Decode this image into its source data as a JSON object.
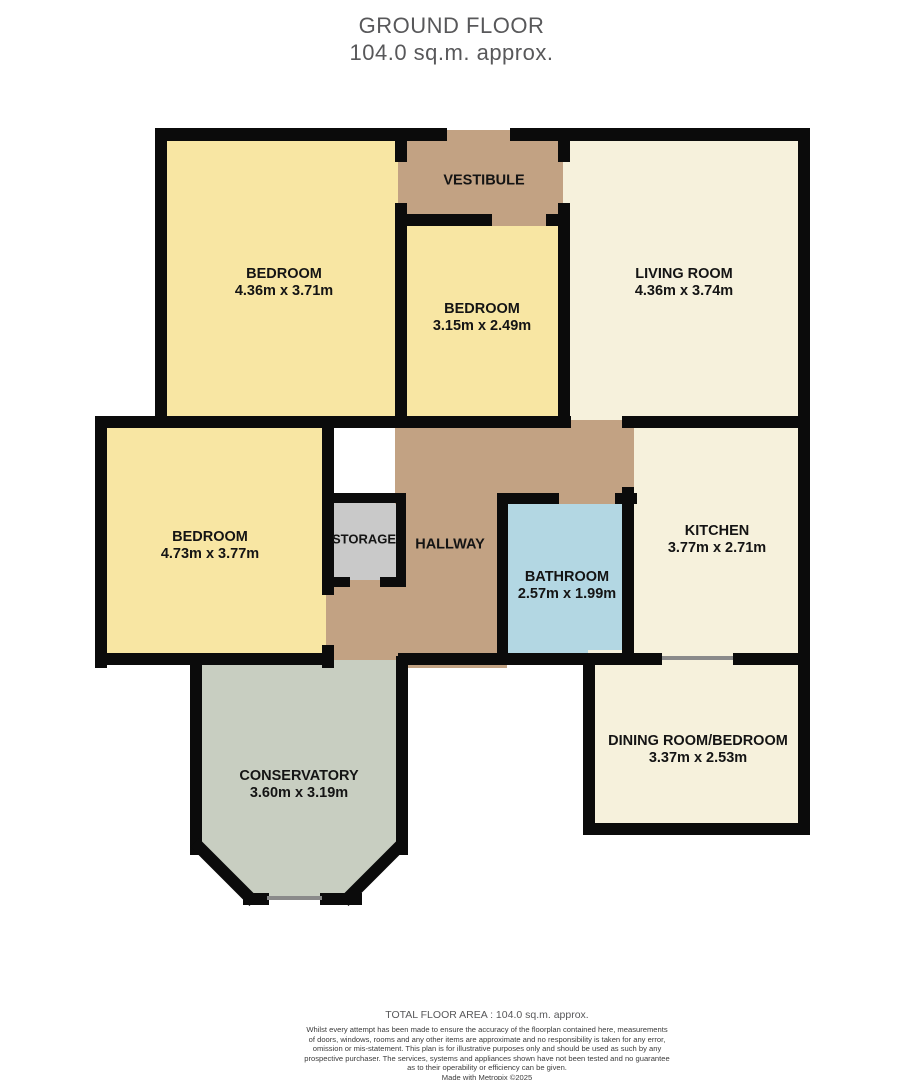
{
  "title": {
    "line1": "GROUND FLOOR",
    "line2": "104.0 sq.m. approx."
  },
  "footer": {
    "total": "TOTAL FLOOR AREA : 104.0 sq.m. approx.",
    "disclaimer": [
      "Whilst every attempt has been made to ensure the accuracy of the floorplan contained here, measurements",
      "of doors, windows, rooms and any other items are approximate and no responsibility is taken for any error,",
      "omission or mis-statement. This plan is for illustrative purposes only and should be used as such by any",
      "prospective purchaser. The services, systems and appliances shown have not been tested and no guarantee",
      "as to their operability or efficiency can be given.",
      "Made with Metropix ©2025"
    ]
  },
  "colors": {
    "bedroom": "#f8e6a3",
    "cream": "#f6f1dc",
    "tan": "#c2a283",
    "storage": "#c9c9c9",
    "bathroom": "#b3d7e3",
    "conservatory": "#c8cec1",
    "wall": "#0b0b0b",
    "window": "#8a8a8a"
  },
  "floorplan": {
    "floors": [
      {
        "name": "bedroom-top-left",
        "color": "bedroom",
        "rect": [
          160,
          133,
          247,
          295
        ]
      },
      {
        "name": "bedroom-middle",
        "color": "bedroom",
        "rect": [
          400,
          218,
          170,
          210
        ]
      },
      {
        "name": "vestibule",
        "color": "tan",
        "rect": [
          398,
          130,
          172,
          96
        ]
      },
      {
        "name": "living-room",
        "color": "cream",
        "rect": [
          563,
          133,
          247,
          295
        ]
      },
      {
        "name": "bedroom-left",
        "color": "bedroom",
        "rect": [
          100,
          420,
          232,
          245
        ]
      },
      {
        "name": "storage",
        "color": "storage",
        "rect": [
          326,
          497,
          76,
          86
        ]
      },
      {
        "name": "bathroom",
        "color": "bathroom",
        "rect": [
          502,
          493,
          128,
          172
        ]
      },
      {
        "name": "kitchen",
        "color": "cream",
        "rect": [
          628,
          420,
          177,
          243
        ]
      },
      {
        "name": "hallway-upper",
        "color": "tan",
        "rect": [
          395,
          420,
          239,
          84
        ]
      },
      {
        "name": "hallway-mid",
        "color": "tan",
        "rect": [
          398,
          499,
          109,
          169
        ]
      },
      {
        "name": "hallway-lower",
        "color": "tan",
        "rect": [
          326,
          580,
          82,
          88
        ]
      },
      {
        "name": "dining-room",
        "color": "cream",
        "rect": [
          588,
          650,
          218,
          185
        ]
      },
      {
        "name": "conservatory",
        "color": "conservatory",
        "rect": [
          196,
          660,
          208,
          240
        ],
        "clip": "polygon(0 0, 100% 0, 100% 79%, 74% 100%, 26% 100%, 0 79%)"
      }
    ],
    "walls": [
      {
        "rect": [
          155,
          128,
          292,
          13
        ]
      },
      {
        "rect": [
          510,
          128,
          300,
          13
        ]
      },
      {
        "rect": [
          798,
          128,
          12,
          537
        ]
      },
      {
        "rect": [
          155,
          128,
          12,
          300
        ]
      },
      {
        "rect": [
          95,
          416,
          76,
          12
        ]
      },
      {
        "rect": [
          95,
          416,
          12,
          252
        ]
      },
      {
        "rect": [
          95,
          653,
          237,
          12
        ]
      },
      {
        "rect": [
          398,
          653,
          264,
          12
        ]
      },
      {
        "rect": [
          733,
          653,
          77,
          12
        ]
      },
      {
        "rect": [
          160,
          416,
          411,
          12
        ]
      },
      {
        "rect": [
          622,
          416,
          188,
          12
        ]
      },
      {
        "rect": [
          395,
          140,
          12,
          22
        ]
      },
      {
        "rect": [
          395,
          203,
          12,
          23
        ]
      },
      {
        "rect": [
          395,
          214,
          97,
          12
        ]
      },
      {
        "rect": [
          546,
          214,
          24,
          12
        ]
      },
      {
        "rect": [
          558,
          140,
          12,
          22
        ]
      },
      {
        "rect": [
          558,
          203,
          12,
          225
        ]
      },
      {
        "rect": [
          395,
          225,
          12,
          203
        ]
      },
      {
        "rect": [
          322,
          493,
          84,
          10
        ]
      },
      {
        "rect": [
          396,
          493,
          10,
          94
        ]
      },
      {
        "rect": [
          322,
          577,
          28,
          10
        ]
      },
      {
        "rect": [
          380,
          577,
          26,
          10
        ]
      },
      {
        "rect": [
          322,
          428,
          12,
          167
        ]
      },
      {
        "rect": [
          322,
          645,
          12,
          23
        ]
      },
      {
        "rect": [
          497,
          493,
          62,
          11
        ]
      },
      {
        "rect": [
          615,
          493,
          22,
          11
        ]
      },
      {
        "rect": [
          497,
          493,
          11,
          172
        ]
      },
      {
        "rect": [
          622,
          487,
          12,
          178
        ]
      },
      {
        "rect": [
          583,
          653,
          12,
          182
        ]
      },
      {
        "rect": [
          583,
          823,
          227,
          12
        ]
      },
      {
        "rect": [
          798,
          653,
          12,
          182
        ]
      },
      {
        "rect": [
          190,
          656,
          12,
          199
        ]
      },
      {
        "rect": [
          396,
          656,
          12,
          199
        ]
      },
      {
        "rect": [
          243,
          893,
          26,
          12
        ]
      },
      {
        "rect": [
          320,
          893,
          42,
          12
        ]
      },
      {
        "rect": [
          182,
          866,
          84,
          12
        ],
        "rotate": 45
      },
      {
        "rect": [
          332,
          866,
          84,
          12
        ],
        "rotate": -45
      }
    ],
    "windows": [
      {
        "name": "window-dining-top",
        "rect": [
          662,
          656,
          71,
          4
        ]
      },
      {
        "name": "window-conservatory-bottom",
        "rect": [
          267,
          896,
          55,
          4
        ]
      }
    ],
    "labels": [
      {
        "name": "bedroom-top-left",
        "lines": [
          "BEDROOM",
          "4.36m  x 3.71m"
        ],
        "cx": 284,
        "cy": 283
      },
      {
        "name": "vestibule",
        "lines": [
          "VESTIBULE"
        ],
        "cx": 484,
        "cy": 181
      },
      {
        "name": "bedroom-middle",
        "lines": [
          "BEDROOM",
          "3.15m  x 2.49m"
        ],
        "cx": 482,
        "cy": 318
      },
      {
        "name": "living-room",
        "lines": [
          "LIVING ROOM",
          "4.36m  x 3.74m"
        ],
        "cx": 684,
        "cy": 283
      },
      {
        "name": "bedroom-left",
        "lines": [
          "BEDROOM",
          "4.73m  x 3.77m"
        ],
        "cx": 210,
        "cy": 546
      },
      {
        "name": "storage",
        "lines": [
          "STORAGE"
        ],
        "cx": 364,
        "cy": 539,
        "size": 13
      },
      {
        "name": "hallway",
        "lines": [
          "HALLWAY"
        ],
        "cx": 450,
        "cy": 545
      },
      {
        "name": "bathroom",
        "lines": [
          "BATHROOM",
          "2.57m  x 1.99m"
        ],
        "cx": 567,
        "cy": 586
      },
      {
        "name": "kitchen",
        "lines": [
          "KITCHEN",
          "3.77m  x 2.71m"
        ],
        "cx": 717,
        "cy": 540
      },
      {
        "name": "dining-room",
        "lines": [
          "DINING ROOM/BEDROOM",
          "3.37m  x 2.53m"
        ],
        "cx": 698,
        "cy": 750
      },
      {
        "name": "conservatory",
        "lines": [
          "CONSERVATORY",
          "3.60m  x 3.19m"
        ],
        "cx": 299,
        "cy": 785
      }
    ]
  }
}
